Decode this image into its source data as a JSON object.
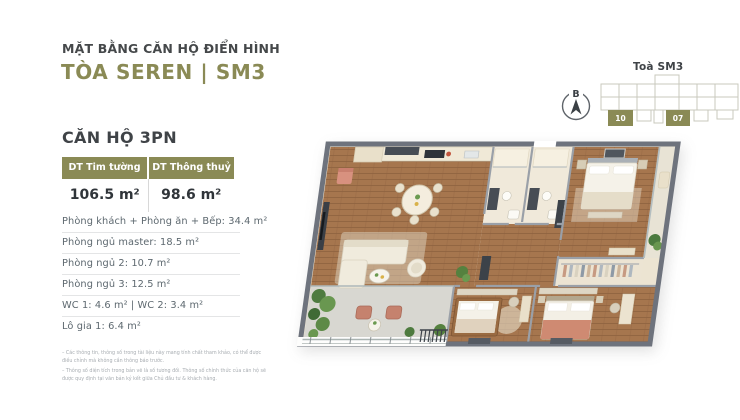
{
  "header": {
    "eyebrow": "MẶT BẰNG CĂN HỘ ĐIỂN HÌNH",
    "title": "TÒA SEREN | SM3"
  },
  "unit": {
    "heading": "CĂN HỘ 3PN",
    "area_table": {
      "col1": {
        "label": "DT Tim tường",
        "value": "106.5 m²"
      },
      "col2": {
        "label": "DT Thông thuỷ",
        "value": "98.6 m²"
      }
    },
    "rooms": [
      "Phòng khách + Phòng ăn + Bếp: 34.4 m²",
      "Phòng ngủ master: 18.5 m²",
      "Phòng ngủ 2: 10.7 m²",
      "Phòng ngủ 3: 12.5 m²",
      "WC 1: 4.6 m² | WC 2: 3.4 m²",
      "Lô gia 1: 6.4 m²"
    ],
    "footnotes": [
      "– Các thông tin, thông số trong tài liệu này mang tính chất tham khảo, có thể được điều chỉnh mà không cần thông báo trước.",
      "– Thông số diện tích trong bản vẽ là số tương đối. Thông số chính thức của căn hộ sẽ được quy định tại văn bản ký kết giữa Chủ đầu tư & khách hàng."
    ]
  },
  "keyplan": {
    "title": "Toà SM3",
    "compass_label": "B",
    "unit_left": "10",
    "unit_right": "07"
  },
  "colors": {
    "accent_olive": "#8A8A55",
    "heading_charcoal": "#414548",
    "body_gray": "#5D686F"
  }
}
